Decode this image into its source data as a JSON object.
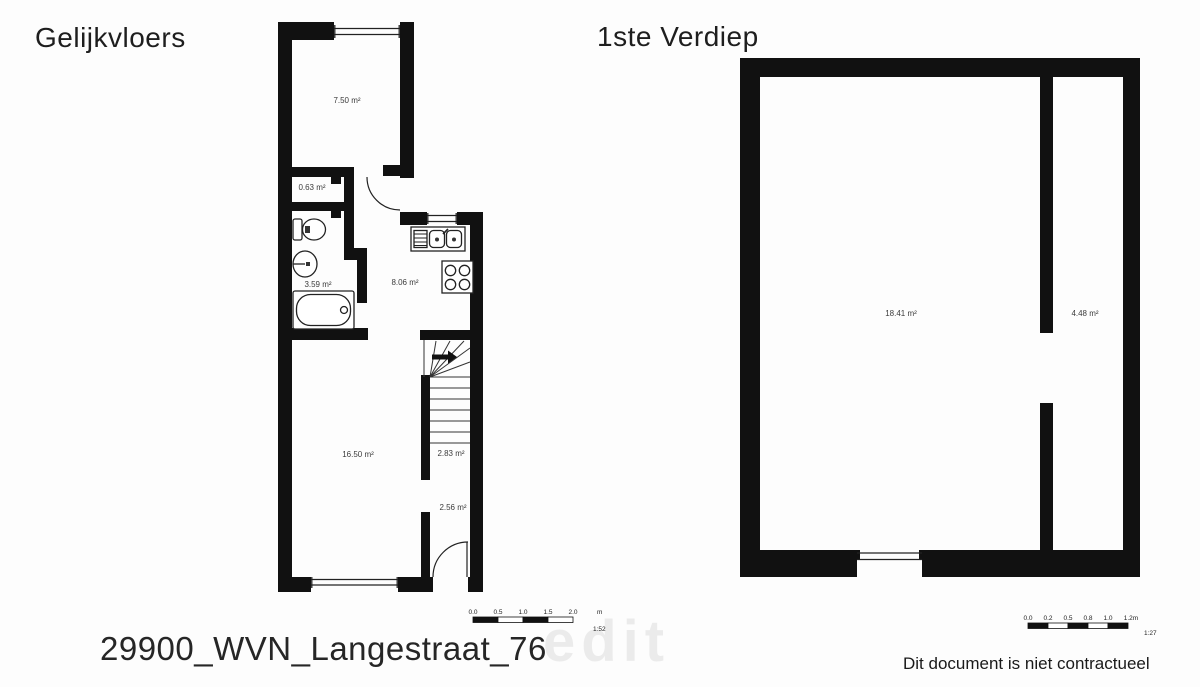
{
  "titles": {
    "ground_floor": "Gelijkvloers",
    "first_floor": "1ste Verdiep"
  },
  "footer": {
    "filename": "29900_WVN_Langestraat_76",
    "watermark": "edit",
    "disclaimer": "Dit document is niet contractueel"
  },
  "ground_floor_plan": {
    "rooms": [
      {
        "id": "front-room",
        "area_label": "7.50 m²"
      },
      {
        "id": "wc",
        "area_label": "0.63 m²"
      },
      {
        "id": "bathroom",
        "area_label": "3.59 m²"
      },
      {
        "id": "kitchen",
        "area_label": "8.06 m²"
      },
      {
        "id": "living-room",
        "area_label": "16.50 m²"
      },
      {
        "id": "stairs",
        "area_label": "2.83 m²"
      },
      {
        "id": "hallway",
        "area_label": "2.56 m²"
      }
    ],
    "scale_bar": {
      "ticks": [
        "0.0",
        "0.5",
        "1.0",
        "1.5",
        "2.0"
      ],
      "unit": "m",
      "ratio": "1:52"
    }
  },
  "first_floor_plan": {
    "rooms": [
      {
        "id": "main-room",
        "area_label": "18.41 m²"
      },
      {
        "id": "side-room",
        "area_label": "4.48 m²"
      }
    ],
    "scale_bar": {
      "ticks": [
        "0.0",
        "0.2",
        "0.5",
        "0.8",
        "1.0",
        "1.2m"
      ],
      "ratio": "1:27"
    }
  },
  "colors": {
    "wall": "#111111",
    "thin_line": "#222222",
    "label_text": "#3b3b3b"
  }
}
